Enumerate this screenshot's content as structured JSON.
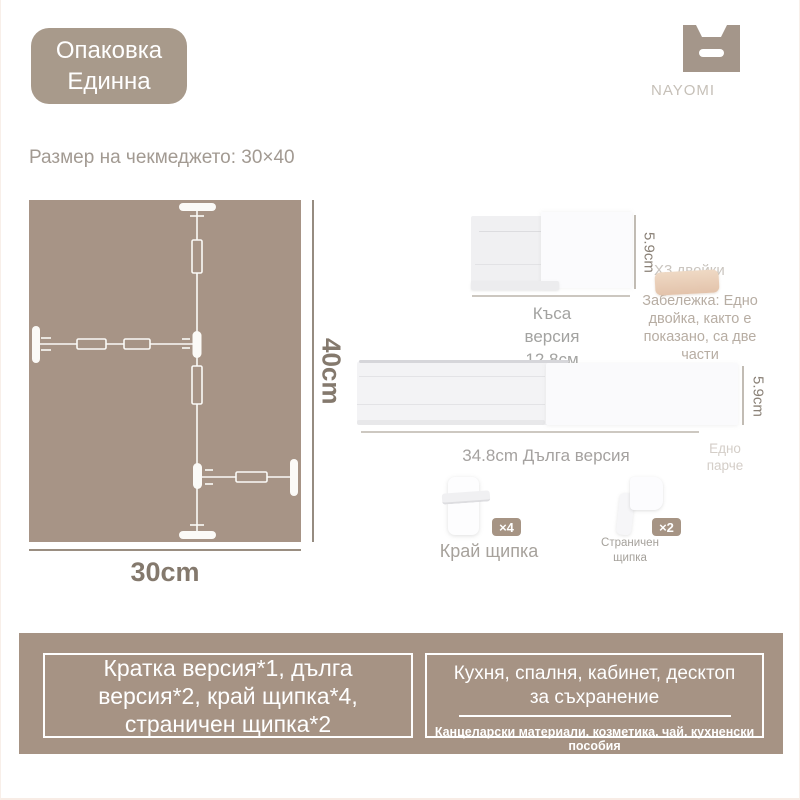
{
  "package_badge": {
    "line1": "Опаковка",
    "line2": "Единна"
  },
  "brand": {
    "name": "NAYOMI"
  },
  "drawer_size_label": "Размер на чекмеджето: 30×40",
  "diagram": {
    "height_label": "40cm",
    "width_label": "30cm"
  },
  "short_version": {
    "height": "5.9cm",
    "label": "Къса версия 12.8см"
  },
  "pair_note": {
    "count": "Х3 двойки",
    "note": "Забележка: Едно двойка, както е показано, са две части"
  },
  "long_version": {
    "height": "5.9cm",
    "label": "34.8cm Дълга версия",
    "one_piece": "Едно парче"
  },
  "clips": {
    "end": {
      "count": "×4",
      "label": "Край щипка"
    },
    "side": {
      "count": "×2",
      "label": "Страничен щипка"
    }
  },
  "package_contents": {
    "lines": [
      "Кратка версия*1, дълга",
      "версия*2, край щипка*4,",
      "страничен щипка*2"
    ]
  },
  "usage": {
    "title_line1": "Кухня, спалня, кабинет, десктоп",
    "title_line2": "за съхранение",
    "subtitle": "Канцеларски материали, козметика, чай, кухненски пособия"
  },
  "colors": {
    "taupe_main": "#a79486",
    "taupe_badge": "#a89a8b",
    "taupe_panel": "#a69384",
    "dimension_text": "#84796d",
    "pair_item_beige": "#e8ccb4",
    "white": "#ffffff"
  }
}
